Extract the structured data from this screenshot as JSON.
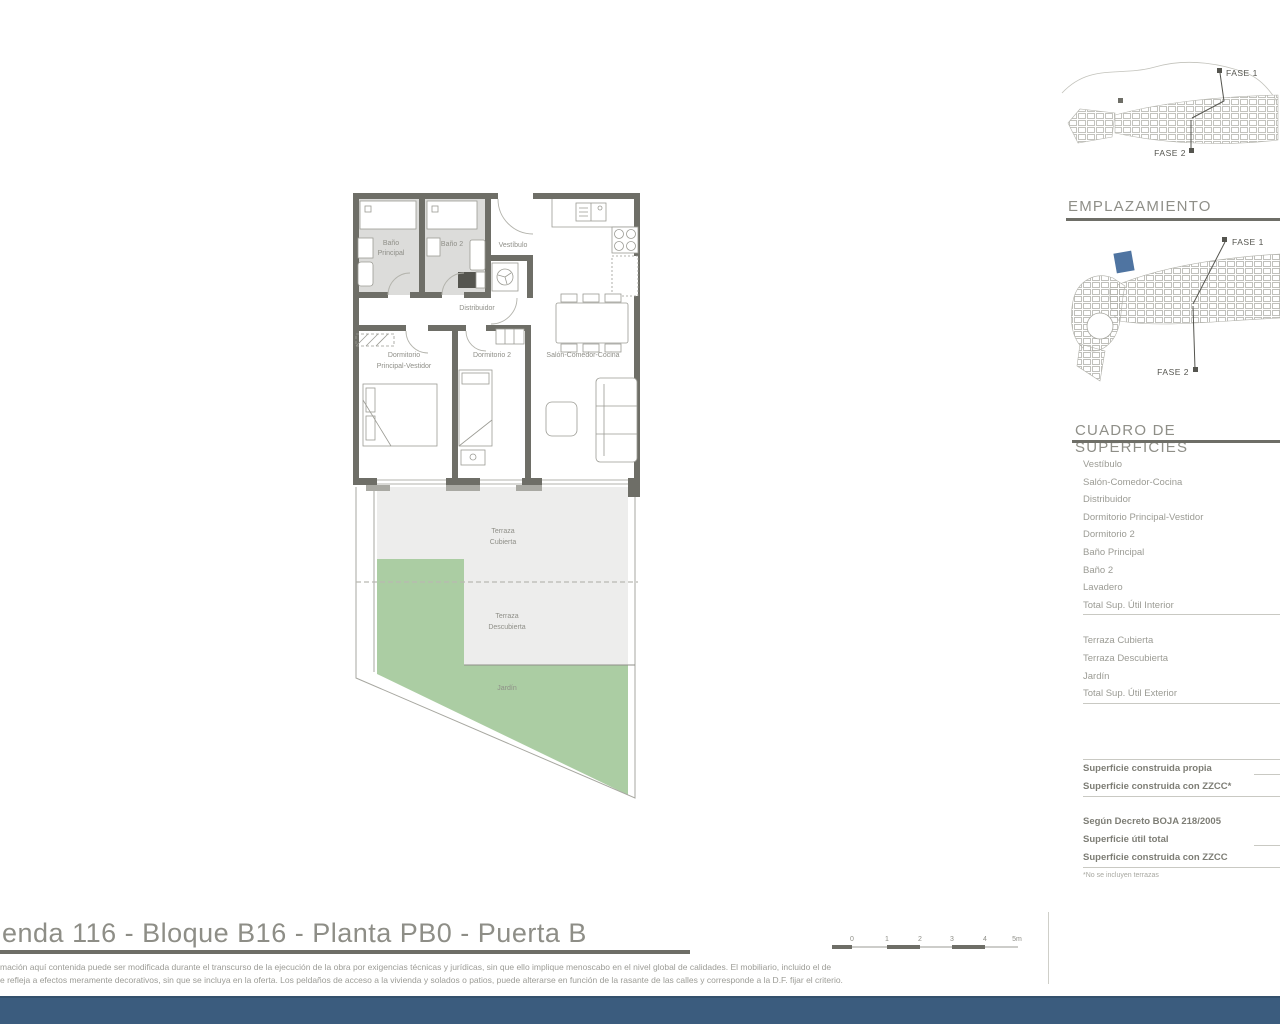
{
  "floorplan": {
    "bano_principal_1": "Baño",
    "bano_principal_2": "Principal",
    "bano_2": "Baño 2",
    "vestibulo": "Vestíbulo",
    "distribuidor": "Distribuidor",
    "dormitorio_principal_1": "Dormitorio",
    "dormitorio_principal_2": "Principal-Vestidor",
    "dormitorio_2": "Dormitorio 2",
    "salon": "Salón-Comedor-Cocina",
    "terraza_cubierta_1": "Terraza",
    "terraza_cubierta_2": "Cubierta",
    "terraza_descubierta_1": "Terraza",
    "terraza_descubierta_2": "Descubierta",
    "jardin": "Jardín"
  },
  "site_maps": {
    "overview": {
      "fase1": "FASE 1",
      "fase2": "FASE 2"
    },
    "emplazamiento": {
      "heading": "EMPLAZAMIENTO",
      "fase1": "FASE 1",
      "fase2": "FASE 2"
    }
  },
  "surfaces_table": {
    "heading": "CUADRO DE SUPERFICIES",
    "interior_rows": [
      "Vestíbulo",
      "Salón-Comedor-Cocina",
      "Distribuidor",
      "Dormitorio Principal-Vestidor",
      "Dormitorio 2",
      "Baño Principal",
      "Baño 2",
      "Lavadero"
    ],
    "interior_total": "Total Sup. Útil Interior",
    "exterior_rows": [
      "Terraza Cubierta",
      "Terraza Descubierta",
      "Jardín"
    ],
    "exterior_total": "Total Sup. Útil Exterior",
    "built_rows": [
      "Superficie construida propia",
      "Superficie construida con ZZCC*"
    ],
    "decree_rows": [
      "Según Decreto BOJA 218/2005",
      "Superficie útil total",
      "Superficie construida con ZZCC"
    ],
    "footnote": "*No se incluyen terrazas"
  },
  "scale_bar": {
    "labels": [
      "0",
      "1",
      "2",
      "3",
      "4",
      "5m"
    ]
  },
  "footer": {
    "title": "enda 116 - Bloque B16 - Planta PB0 - Puerta B",
    "disclaimer_line1": "mación aquí contenida puede  ser modificada durante el transcurso de la ejecución de la obra por exigencias técnicas y jurídicas,  sin  que  ello  implique  menoscabo  en el nivel global de calidades.  El  mobiliario, incluido el de",
    "disclaimer_line2": "e refleja a efectos meramente decorativos, sin que se incluya en la oferta. Los peldaños de acceso a la vivienda y  solados  o patios,  puede alterarse  en función de la rasante de las calles y corresponde a  la  D.F.  fijar el criterio."
  },
  "colors": {
    "wall": "#6e6e67",
    "bath_floor": "#dcdcda",
    "terrace": "#ededec",
    "garden": "#abcda3",
    "accent_bar": "#3b5c7e",
    "map_highlight": "#4f74a1",
    "text_gray": "#8f8f88"
  }
}
